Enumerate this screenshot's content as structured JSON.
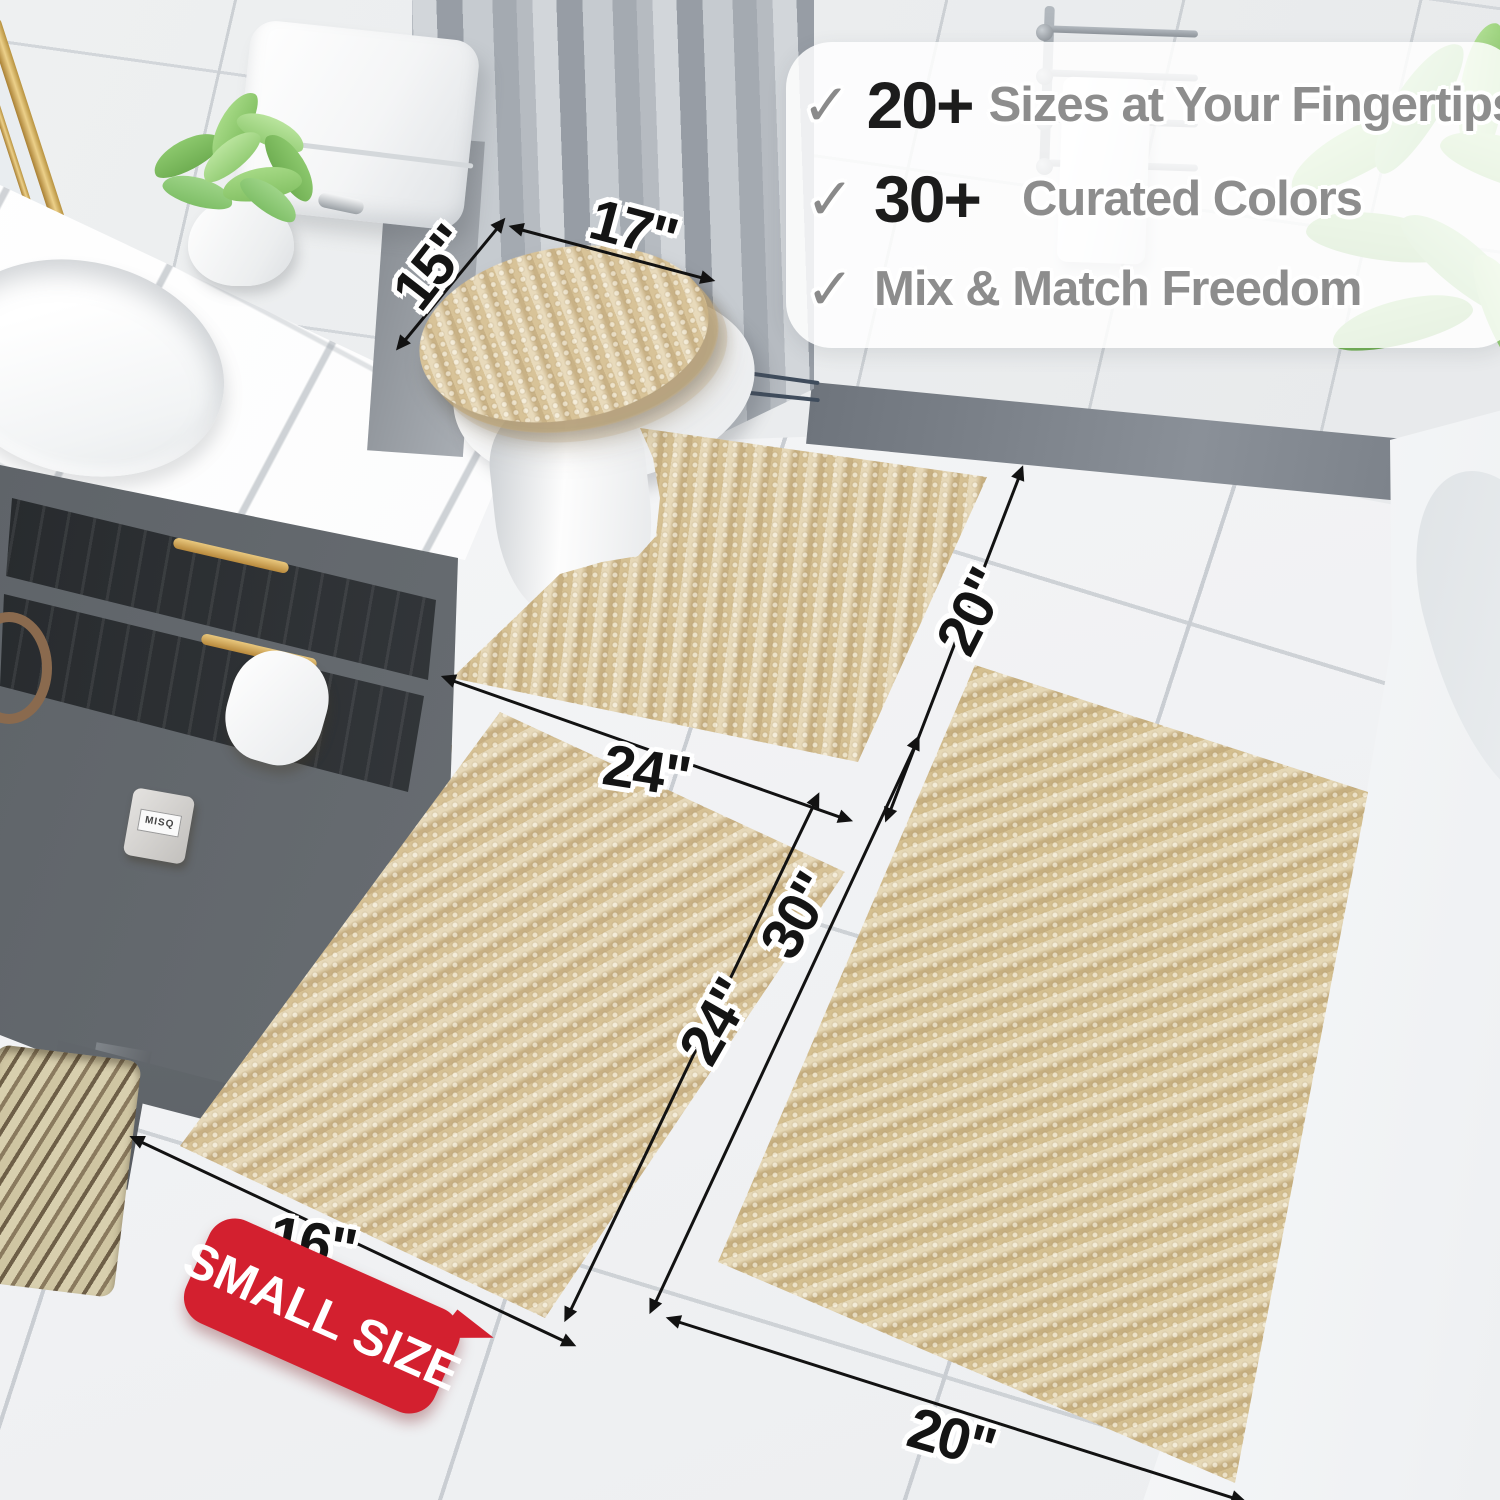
{
  "banner": {
    "check_glyph": "✓",
    "rows": [
      {
        "number": "20+",
        "label": "Sizes at Your Fingertips"
      },
      {
        "number": "30+",
        "label": "Curated Colors"
      },
      {
        "number": "",
        "label": "Mix & Match Freedom"
      }
    ]
  },
  "dimensions": {
    "lid_width": "15\"",
    "lid_length": "17\"",
    "contour_width": "24\"",
    "contour_depth": "20\"",
    "runner_length": "24\"",
    "large_length": "30\"",
    "small_width": "16\"",
    "large_width": "20\""
  },
  "badge": {
    "label": "SMALL SIZE"
  },
  "props": {
    "perfume_label": "MISQ"
  },
  "palette": {
    "rug_beige": "#d6c195",
    "badge_red": "#d3202f",
    "number_black": "#1c1c1c",
    "label_gray": "#8d8d8d",
    "check_gray": "#8a8a8a"
  }
}
